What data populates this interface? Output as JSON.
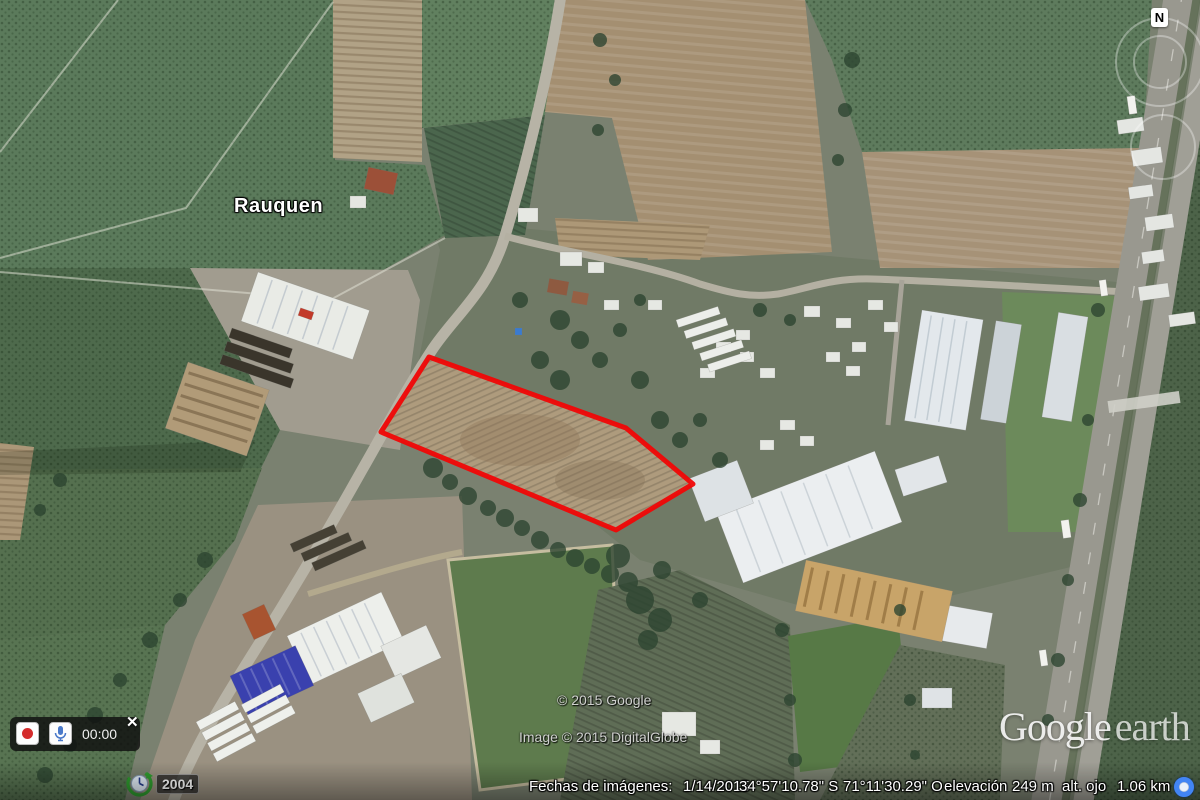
{
  "map": {
    "place_label": "Rauquen",
    "compass_north": "N",
    "copyright_line1": "© 2015 Google",
    "copyright_line2": "Image © 2015 DigitalGlobe",
    "watermark_google": "Google",
    "watermark_earth": "earth"
  },
  "recorder": {
    "time": "00:00",
    "close_label": "✕"
  },
  "timeline": {
    "year": "2004"
  },
  "status_bar": {
    "imagery_date_label": "Fechas de imágenes:",
    "imagery_date": "1/14/2015",
    "latitude": "34°57'10.78\" S",
    "longitude": "71°11'30.29\" O",
    "elevation_label": "elevación",
    "elevation_value": "249 m",
    "eye_alt_label": "alt. ojo",
    "eye_alt_value": "1.06 km"
  },
  "colors": {
    "parcel_outline": "#f00606",
    "accent_blue": "#4285f4"
  }
}
